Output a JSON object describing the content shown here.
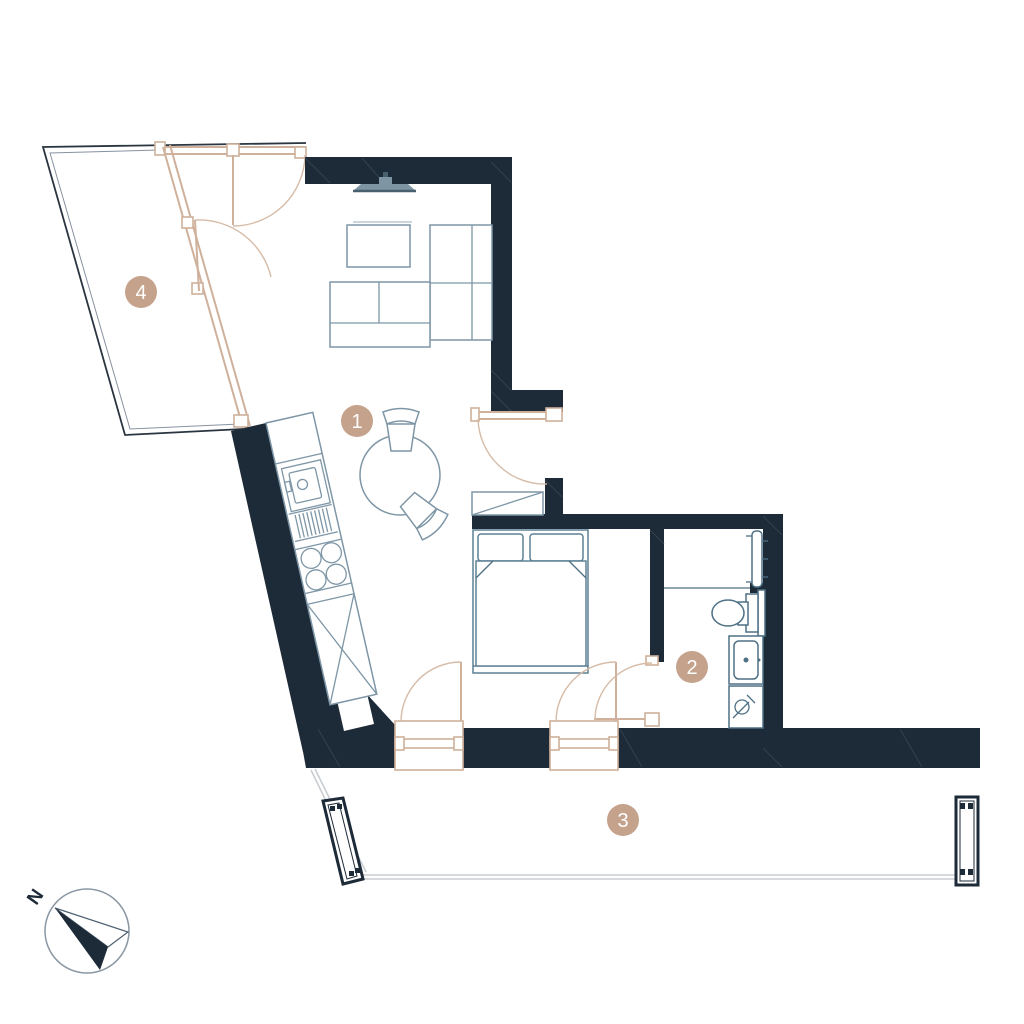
{
  "title": "Apartment floor plan",
  "colors": {
    "wall": "#1d2a37",
    "furniture_stroke": "#7e96a6",
    "bathroom_stroke": "#4e7085",
    "tan_accent": "#cfb09b",
    "room_marker_fill": "#c5a28c",
    "room_marker_text": "#ffffff",
    "terrace_edge": "#c9ced3",
    "paper": "#ffffff",
    "tv_fill": "#7e95a4"
  },
  "compass": {
    "label": "N",
    "direction": "north-west"
  },
  "rooms": [
    {
      "label": "1",
      "name": "living-dining-kitchen",
      "marker_x": 357,
      "marker_y": 421
    },
    {
      "label": "2",
      "name": "bathroom",
      "marker_x": 692,
      "marker_y": 667
    },
    {
      "label": "3",
      "name": "terrace",
      "marker_x": 623,
      "marker_y": 820
    },
    {
      "label": "4",
      "name": "balcony",
      "marker_x": 141,
      "marker_y": 292
    }
  ],
  "furniture": [
    "wall-mounted-tv",
    "corner-sofa",
    "coffee-table",
    "round-dining-table",
    "dining-chairs",
    "kitchen-counter",
    "kitchen-sink",
    "cooktop-4-burners",
    "tall-cabinet",
    "double-bed",
    "wardrobe",
    "towel-radiator",
    "toilet",
    "washbasin-vanity",
    "washing-machine"
  ]
}
